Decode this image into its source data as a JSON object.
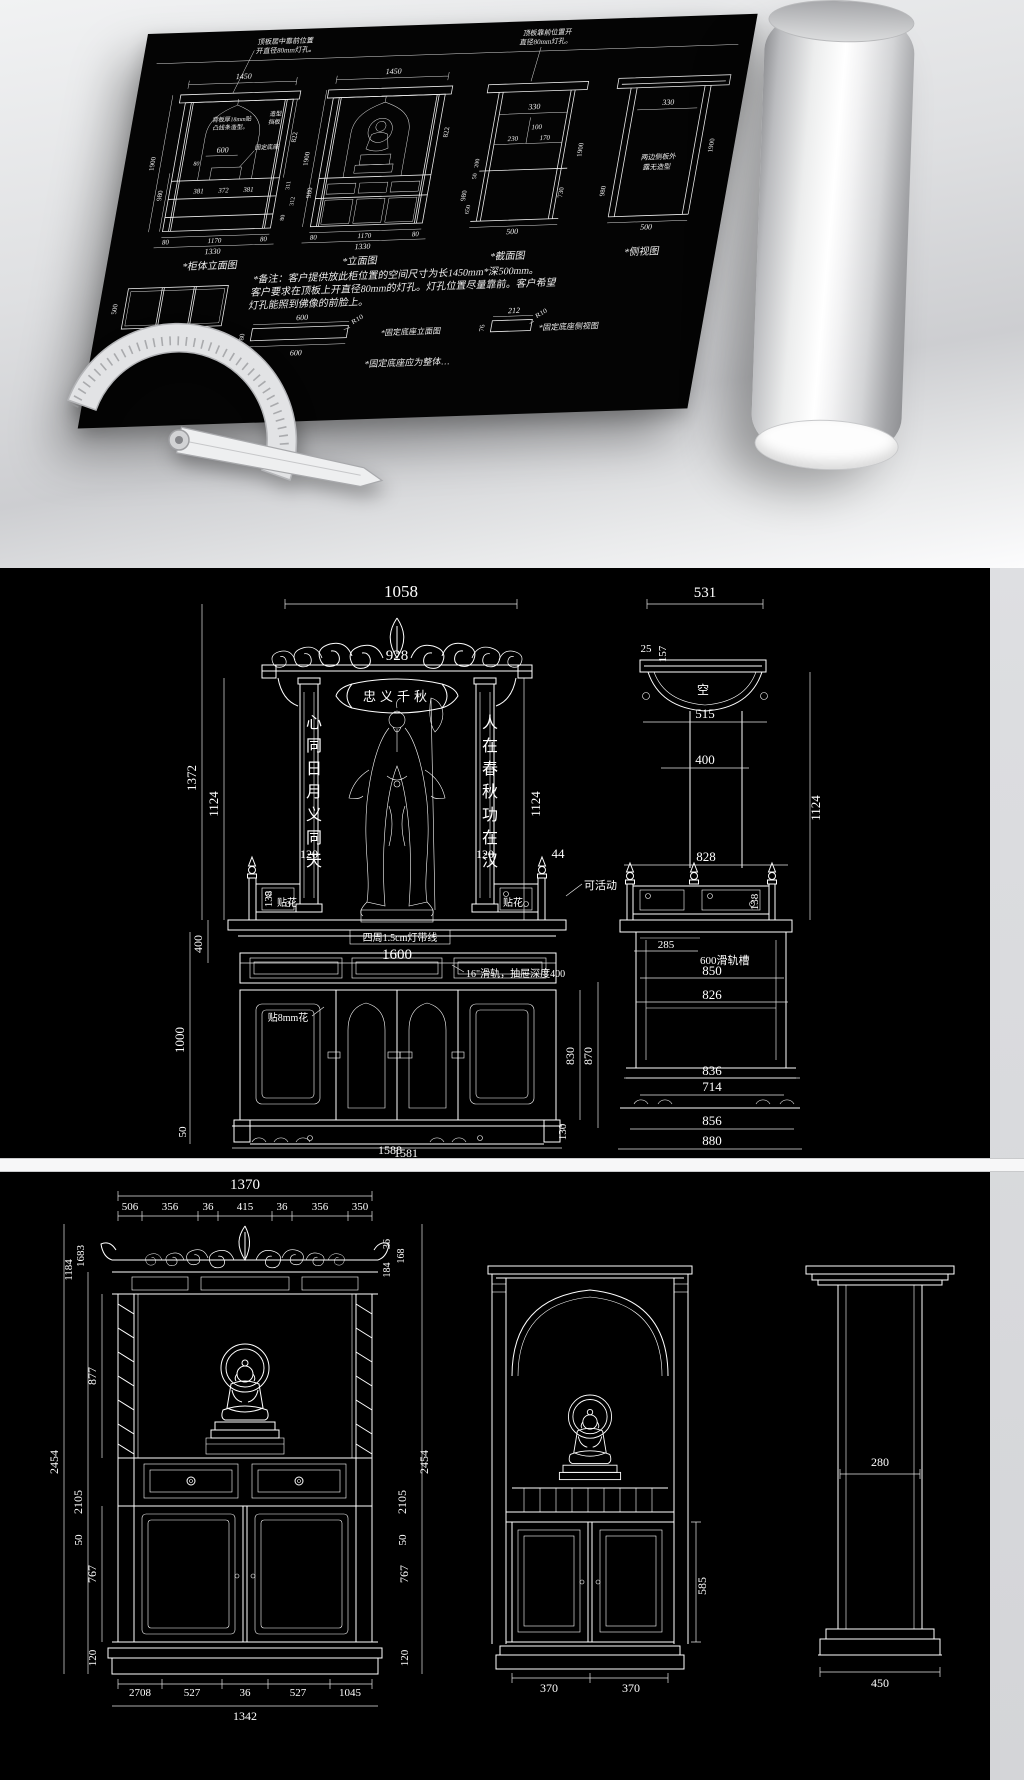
{
  "top": {
    "notes1": "*备注：客户提供放此柜位置的空间尺寸为长1450mm*深500mm。",
    "notes2": "客户要求在顶板上开直径80mm的灯孔。灯孔位置尽量靠前。客户希望",
    "notes3": "灯孔能照到佛像的前脸上。",
    "lab_cab": "*柜体立面图",
    "lab_elev": "*立面图",
    "lab_sec": "*截面图",
    "lab_side": "*侧视图",
    "lab_top": "*俯视图",
    "lab_base_elev": "*固定底座立面图",
    "lab_base_side": "*固定底座侧视图",
    "lab_base_note": "*固定底座应为整体…",
    "ann_lamp_a1": "顶板居中靠前位置",
    "ann_lamp_a2": "开直径80mm灯孔。",
    "ann_back1": "背板厚18mm贴",
    "ann_back2": "凸线条造型。",
    "ann_shape1": "造型",
    "ann_shape2": "挡板",
    "ann_base": "固定底座",
    "ann_lamp_c1": "顶板靠前位置开",
    "ann_lamp_c2": "直径80mm灯孔。",
    "ann_side1": "两边侧板外",
    "ann_side2": "露无造型",
    "d1450": "1450",
    "d1900": "1900",
    "d980": "980",
    "d822": "822",
    "d600": "600",
    "d80": "80",
    "d381": "381",
    "d372": "372",
    "d311": "311",
    "d312": "312",
    "d1170": "1170",
    "d1330": "1330",
    "d330": "330",
    "d100": "100",
    "d230": "230",
    "d170": "170",
    "d200": "200",
    "d50": "50",
    "d730": "730",
    "d650": "650",
    "d500": "500",
    "dR10": "R10",
    "d212": "212",
    "d76": "76"
  },
  "mid": {
    "d1058": "1058",
    "d928": "928",
    "banner": "忠义千秋",
    "colL": "心同日月义同天",
    "colR": "人在春秋功在汉",
    "d1372": "1372",
    "d1124": "1124",
    "d120": "120",
    "d138": "138",
    "d44": "44",
    "decal": "贴花",
    "movable": "可活动",
    "d1600": "1600",
    "led": "四周1.5cm灯带线",
    "slide": "16\"滑轨，抽屉深度400",
    "d400": "400",
    "d1000": "1000",
    "d50": "50",
    "d830": "830",
    "d870": "870",
    "d130": "130",
    "flower": "贴8mm花",
    "d1588": "1588",
    "d1581": "1581",
    "d531": "531",
    "d25": "25",
    "d157": "157",
    "empty": "空",
    "d515": "515",
    "d828": "828",
    "d285": "285",
    "slot": "600滑轨槽",
    "d850": "850",
    "d826": "826",
    "d836": "836",
    "d714": "714",
    "d856": "856",
    "d880": "880"
  },
  "bot": {
    "d1370": "1370",
    "s1": "506",
    "s2": "356",
    "s3": "36",
    "s4": "415",
    "s5": "350",
    "v1683": "1683",
    "v1184": "1184",
    "v877": "877",
    "v2454": "2454",
    "v2105": "2105",
    "v50": "50",
    "v767": "767",
    "v120": "120",
    "r36": "36",
    "r184": "184",
    "r168": "168",
    "b1": "2708",
    "b2": "527",
    "b5": "1045",
    "total": "1342",
    "d370": "370",
    "d585": "585",
    "d280": "280",
    "d450": "450"
  }
}
